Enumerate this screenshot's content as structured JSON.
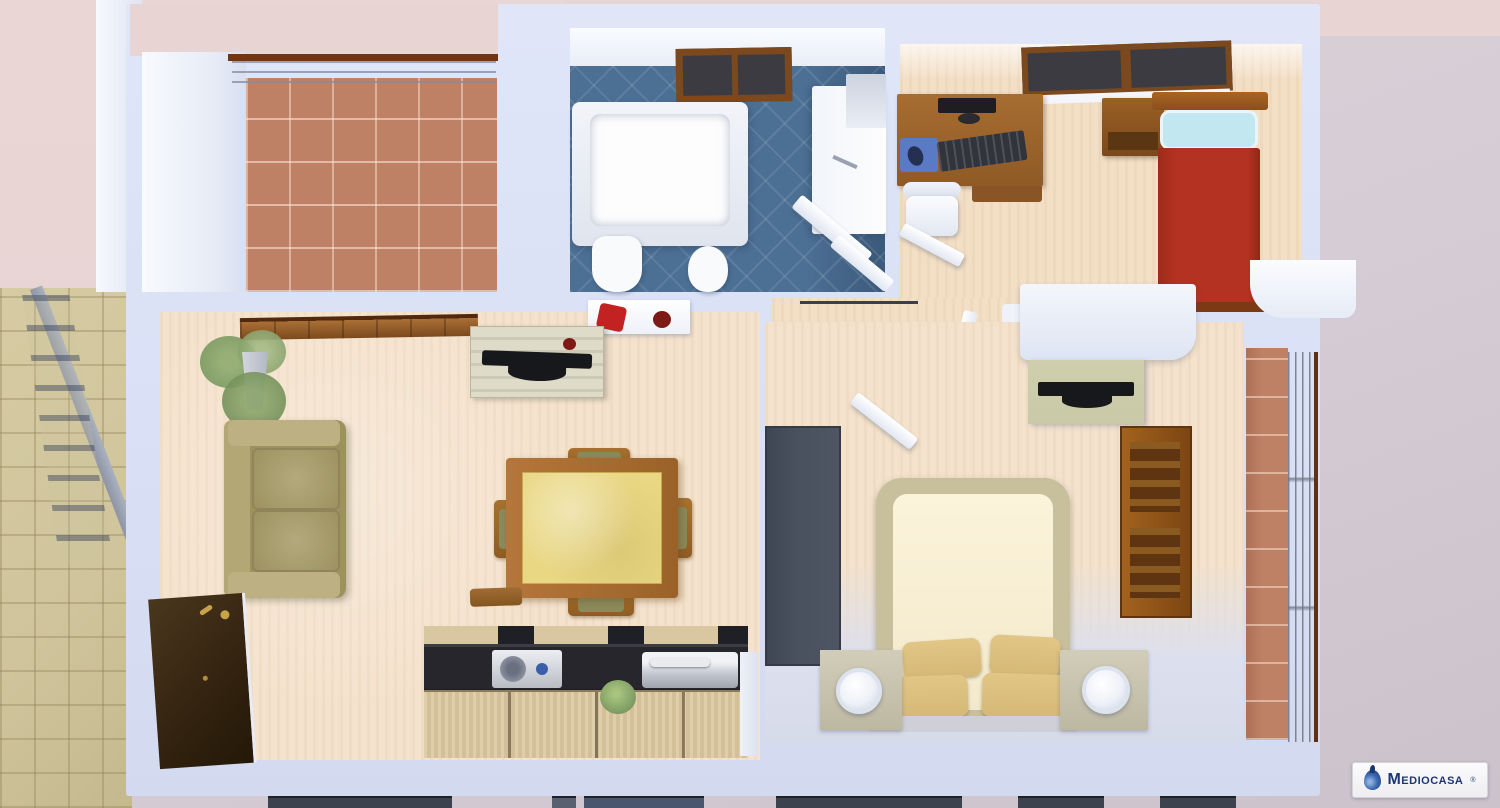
{
  "scene": {
    "description": "3D rendered top-down floor plan of a two-bedroom apartment with terrace, bathroom, study bedroom, living room with kitchen, master bedroom, side balcony and external stairwell"
  },
  "logo": {
    "brand": "Mediocasa",
    "registered_mark": "®",
    "icon": "water-drop-icon"
  },
  "colors": {
    "bg_pink": "#e8d4d3",
    "bg_mauve": "#d5ccd5",
    "wall": "#dbe1f6",
    "stairs_tile": "#cfc49b",
    "terrace_brick": "#bf8166",
    "bath_tile": "#4c6f94",
    "floor_peach": "#f3dfc6",
    "floor_peach2": "#f4e2cc",
    "wood_mid": "#a06a30",
    "wood_dark": "#7c491e",
    "glass_dark": "#3b3b41",
    "sofa": "#a79b66",
    "sofa_light": "#bdb083",
    "table_top": "#e9d784",
    "red_bed": "#b43222",
    "pillow_blue": "#c3e7f0",
    "mousepad_blue": "#5b7ac6",
    "counter_black": "#26262c",
    "bed_frame": "#c8bf9d",
    "bed_mattress": "#f3e9cc",
    "pillow_tan": "#d5b876",
    "wardrobe_gray": "#49505e",
    "cabinet_sage": "#c9c9a8",
    "plant_green": "#7d9a62",
    "accent_red": "#c32222",
    "accent_dark_red": "#7e1a16",
    "logo_navy": "#1c3672",
    "logo_blue": "#3a6ab0"
  }
}
